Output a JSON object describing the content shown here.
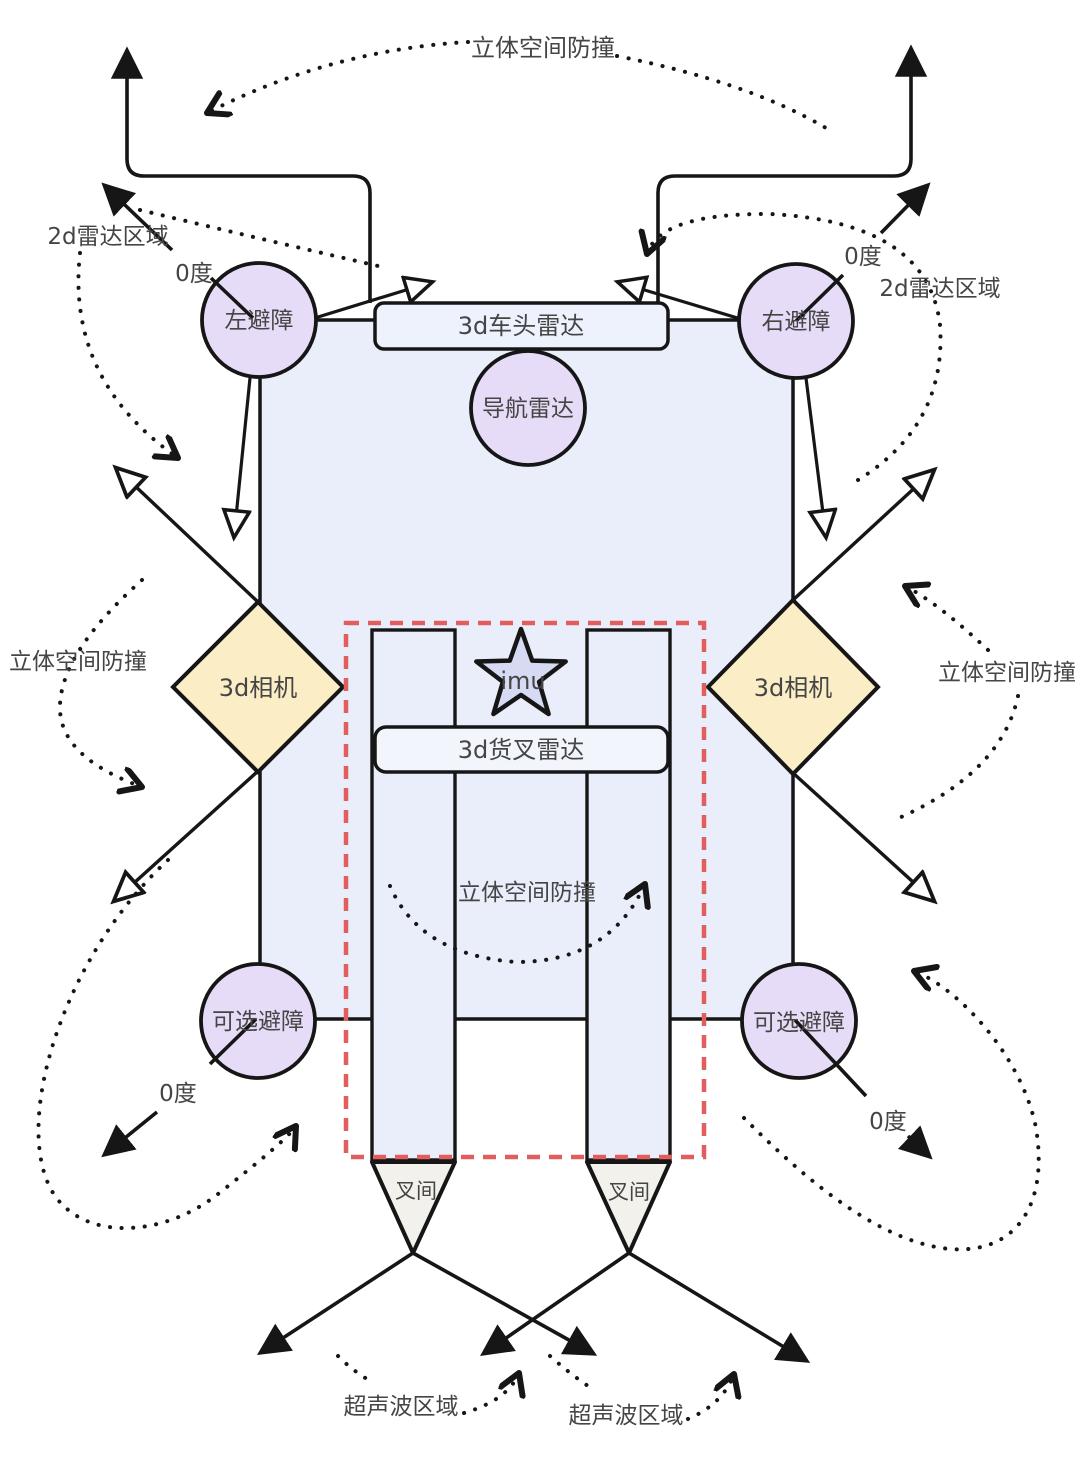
{
  "labels": {
    "stereo_collision": "立体空间防撞",
    "radar_2d_area": "2d雷达区域",
    "zero_degree": "0度",
    "left_avoid": "左避障",
    "right_avoid": "右避障",
    "head_radar_3d": "3d车头雷达",
    "nav_radar": "导航雷达",
    "camera_3d": "3d相机",
    "imu": "imu",
    "fork_radar_3d": "3d货叉雷达",
    "optional_avoid": "可选避障",
    "fork_gap": "叉间",
    "ultrasonic_area": "超声波区域"
  },
  "colors": {
    "body": "#e9eefa",
    "head_box": "#eef2fc",
    "fork_box": "#f3f5fd",
    "circle": "#e7dcf7",
    "star": "#d7daf3",
    "diamond": "#fbedc6",
    "triangle": "#f2f1ec",
    "dashed_zone": "#e25d5d",
    "line": "#161616",
    "text": "#454545"
  }
}
